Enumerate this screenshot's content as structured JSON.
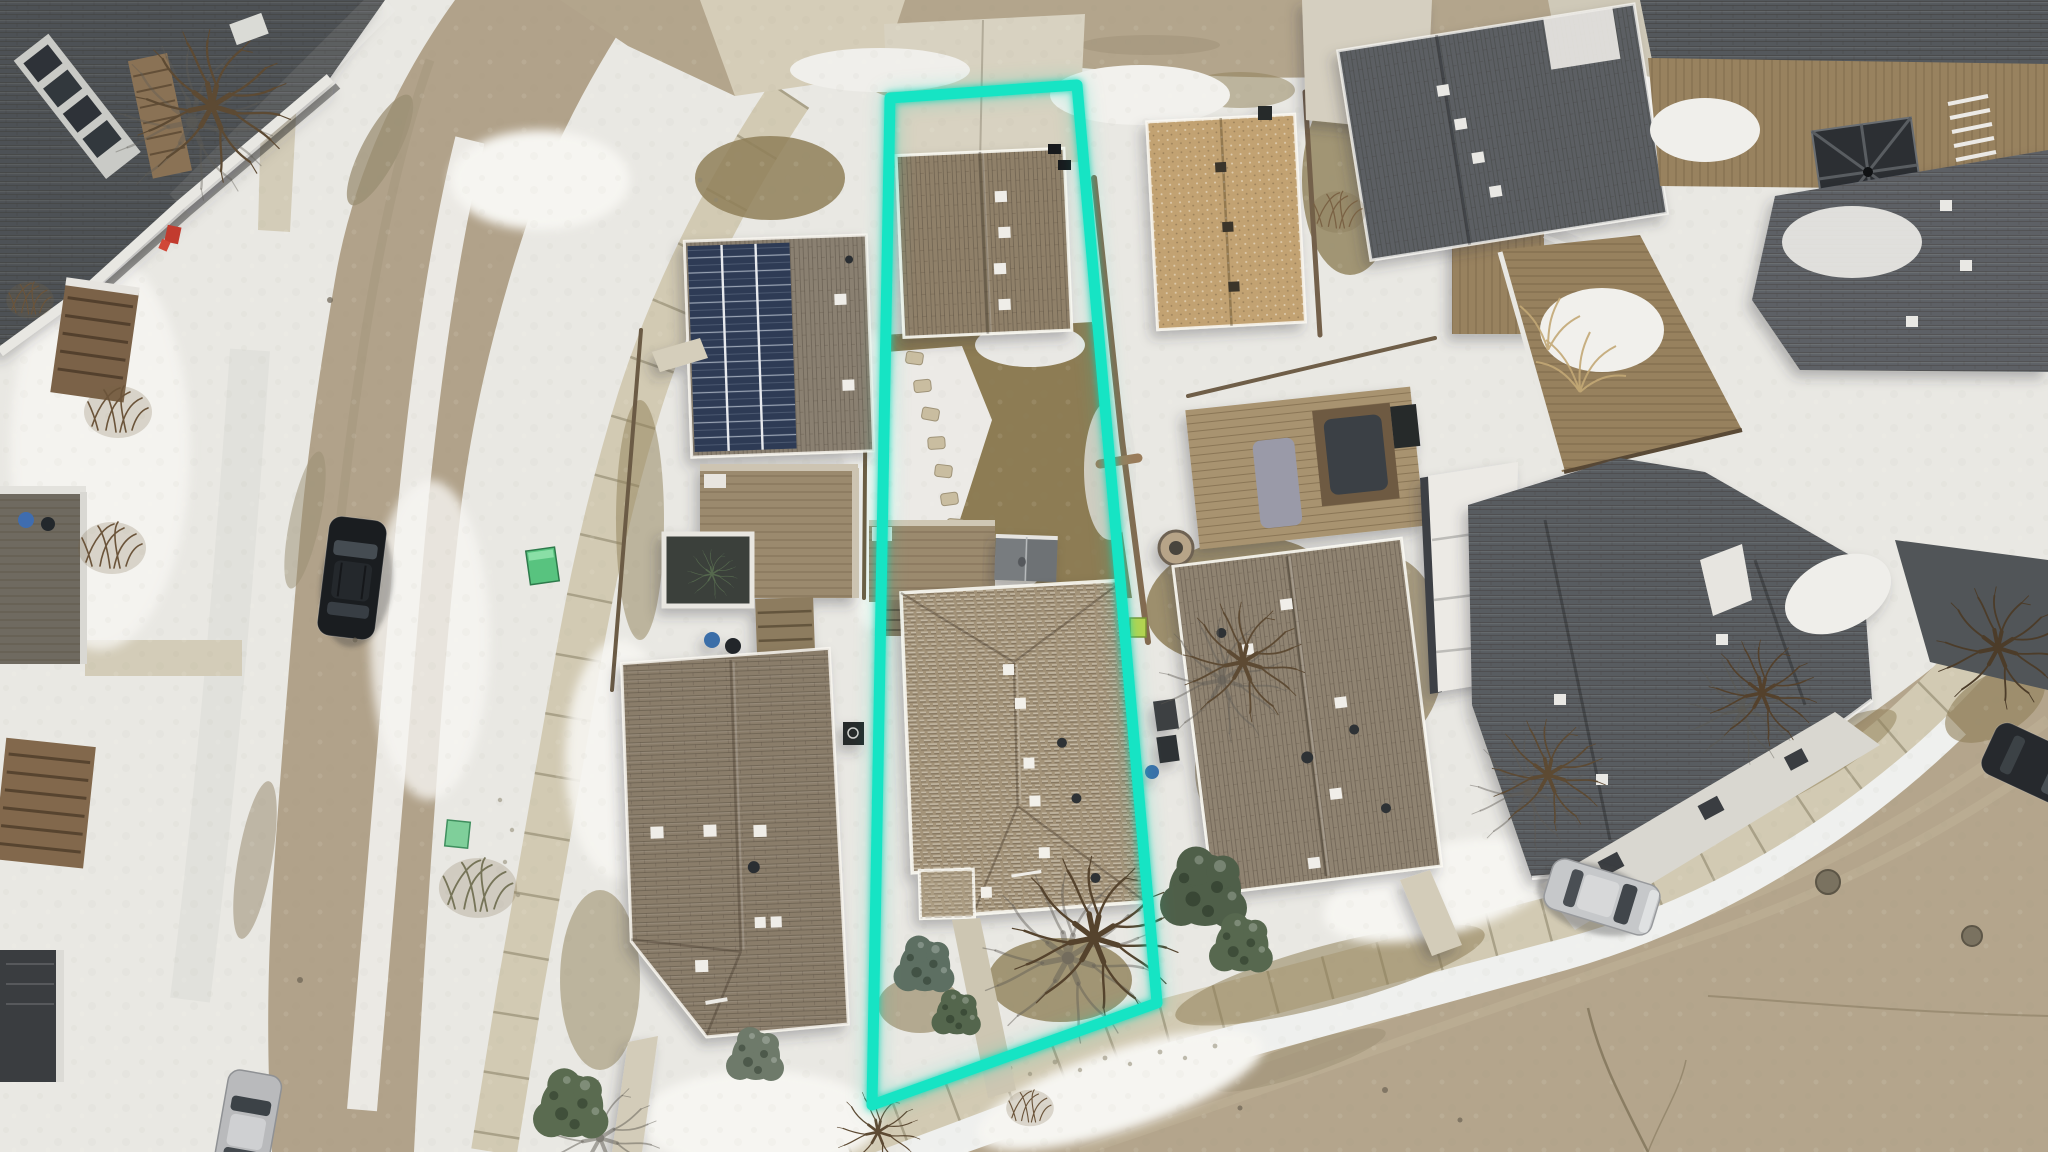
{
  "scene": {
    "type": "aerial-drone-photo",
    "season": "winter",
    "description": "Top-down winter aerial photo of a suburban block: snow-covered yards, tan dirt streets on the left and lower right, shingled rooftops, parked cars, bare trees, and a bright teal polygon outlining the subject property lot in the center.",
    "annotation": "teal property boundary outline around center lot"
  },
  "property_outline": {
    "color": "#19e4c4",
    "glow_color": "#0fc9ac",
    "stroke_width": 11,
    "points_str": "890,98 1077,85 1157,1003 872,1105"
  },
  "palette": {
    "snow": "#e9e8e3",
    "snow_bright": "#f6f5f1",
    "snow_shadow": "#d8d8d3",
    "road_tan": "#b1a28a",
    "sidewalk": "#d2cab3",
    "concrete": "#d8d2c1",
    "dirt_grass": "#8f7f58",
    "dark_roof": "#5b5f63",
    "brown_roof": "#8f8069",
    "subject_roof": "#a39379",
    "tan_roof": "#c2a272",
    "deck_wood": "#9b8a6e",
    "solar_panel": "#2d3b55",
    "evergreen": "#54664d",
    "branch": "#5d4a33"
  },
  "inventory": {
    "subject_lot": [
      "driveway",
      "garage-roof",
      "stepping-stones",
      "rear-deck",
      "gray-shed",
      "main-house-hip-roof",
      "front-porch",
      "front-walkway",
      "bare-tree",
      "conifers"
    ],
    "houses": [
      "townhouse-top-left",
      "solar-panel-house",
      "house-bottom-left",
      "tan-roof-house",
      "neighbor-house-right",
      "dark-roof-complex-right"
    ],
    "vehicles": [
      "black-suv-left-street",
      "silver-car-bottom-left",
      "silver-sedan-bottom-right-street",
      "dark-car-right-edge"
    ],
    "site_objects": [
      "green-utility-box-upper",
      "green-utility-box-lower",
      "lime-utility-box",
      "manhole-covers",
      "gazebo",
      "hot-tub",
      "fire-pit",
      "road-cracks",
      "red-object-porch"
    ],
    "vegetation": [
      "bare-deciduous-trees",
      "evergreen-bushes",
      "bare-shrubs",
      "ornamental-grasses"
    ]
  }
}
